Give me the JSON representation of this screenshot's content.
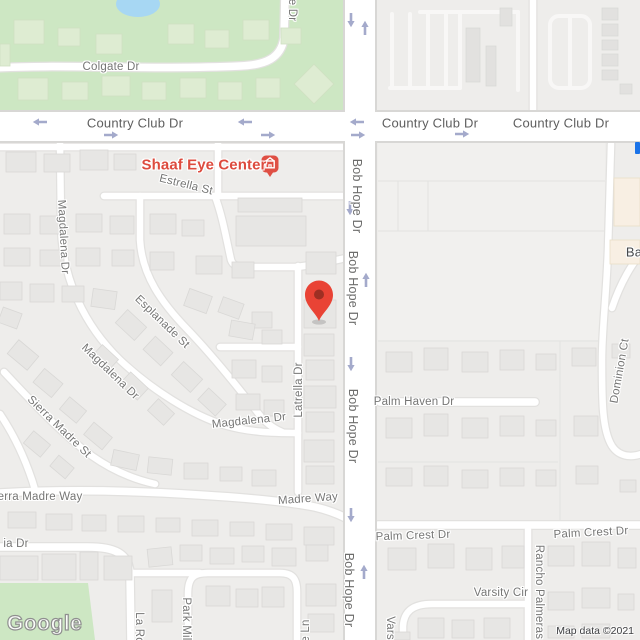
{
  "map_type": "google-maps-static-embed",
  "poi": {
    "label": "Shaaf Eye Center"
  },
  "labels": {
    "colgate": "Colgate Dr",
    "e_dr_cut": "e Dr",
    "country_club_1": "Country Club Dr",
    "country_club_2": "Country Club Dr",
    "country_club_3": "Country Club Dr",
    "estrella": "Estrella St",
    "bob_hope_1": "Bob Hope Dr",
    "bob_hope_2": "Bob Hope Dr",
    "bob_hope_3": "Bob Hope Dr",
    "bob_hope_4": "Bob Hope Dr",
    "magdalena_vertical": "Magdalena Dr",
    "esplanade": "Esplanade St",
    "magdalena_diagonal": "Magdalena Dr",
    "sierra_madre_st": "Sierra Madre St",
    "magdalena_horizontal": "Magdalena Dr",
    "latrella": "Latrella Dr",
    "madre_way": "Madre Way",
    "sierra_madre_way_cut": "erra Madre Way",
    "ia_dr_cut": "ia Dr",
    "palm_haven": "Palm Haven Dr",
    "dominion_ct": "Dominion Ct",
    "palm_crest_1": "Palm Crest Dr",
    "palm_crest_2": "Palm Crest Dr",
    "rancho_palmeras": "Rancho Palmeras",
    "varsity_cir": "Varsity Cir",
    "varsity_cut": "Vars",
    "la_ro_cut": "La Ro",
    "park_mi_cut": "Park Mil",
    "e_ln_cut": "e Ln",
    "ba_cut": "Ba"
  },
  "watermark": {
    "logo": "Google",
    "attribution": "Map data ©2021"
  },
  "icons": [
    "destination-pin-icon",
    "poi-building-icon",
    "one-way-arrow-icon"
  ],
  "colors": {
    "park_green": "#cde7c3",
    "water_blue": "#a7d7f3",
    "road_white": "#ffffff",
    "block_gray": "#eeedeb",
    "building_gray": "#e7e6e4",
    "commercial_cream": "#f8efe3",
    "poi_red": "#dd4b3e",
    "pin_red": "#e94335",
    "arrow_blue": "#a4aacb",
    "label_gray": "#767675",
    "marker_blue_fragment": "#1a73e8"
  }
}
